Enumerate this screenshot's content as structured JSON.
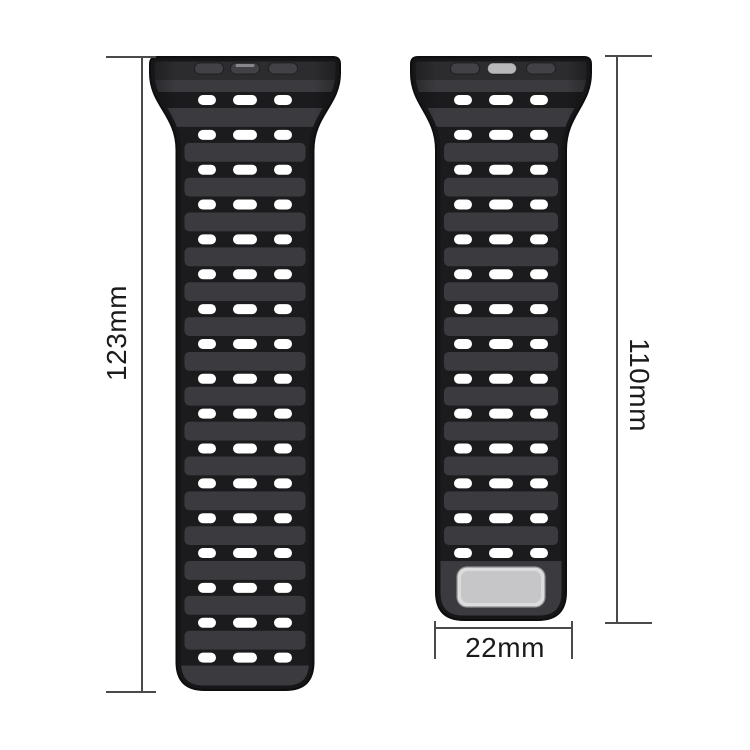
{
  "labels": {
    "left_length": "123mm",
    "right_length": "110mm",
    "width": "22mm"
  },
  "colors": {
    "background": "#ffffff",
    "strap_base": "#1b1b1d",
    "strap_plate": "#3b3b3f",
    "strap_connector": "#2c2c2f",
    "strap_edge": "#161618",
    "strap_outline": "#0e0e0f",
    "hole": "#ffffff",
    "slot_dark": "#424246",
    "slot_light": "#b8b8ba",
    "slot_highlight": "#8f8f93",
    "buckle_outer": "#dcdcdd",
    "buckle_inner": "#c6c6c8",
    "buckle_stroke": "#909094",
    "dimension_line": "#4a4a4a",
    "dimension_text": "#1b1b1b"
  },
  "straps": [
    {
      "name": "strap-long",
      "length_label": "123mm",
      "rows": 17,
      "holes_per_row": 3,
      "center_slot_light": false,
      "center_slot_highlight": true,
      "has_buckle": false,
      "geometry": {
        "cx": 245,
        "top_y": 57,
        "top_w": 190,
        "band_w": 137,
        "flare_end_y": 150,
        "bottom_y": 690,
        "row_start_y": 100,
        "row_step": 34.85,
        "hole_offsets": [
          -38,
          0,
          38
        ],
        "hole_widths": [
          18,
          24,
          18
        ],
        "hole_h": 10,
        "slot_offsets": [
          -36,
          0,
          38
        ],
        "slot_w": 29,
        "slot_h": 11
      }
    },
    {
      "name": "strap-short",
      "length_label": "110mm",
      "rows": 14,
      "holes_per_row": 3,
      "center_slot_light": true,
      "center_slot_highlight": false,
      "has_buckle": true,
      "geometry": {
        "cx": 501,
        "top_y": 57,
        "top_w": 180,
        "band_w": 130,
        "flare_end_y": 150,
        "bottom_y": 620,
        "row_start_y": 100,
        "row_step": 34.85,
        "hole_offsets": [
          -38,
          0,
          38
        ],
        "hole_widths": [
          18,
          24,
          18
        ],
        "hole_h": 10,
        "slot_offsets": [
          -36,
          1,
          40
        ],
        "slot_w": 29,
        "slot_h": 11
      },
      "buckle": {
        "w": 88,
        "h": 40,
        "cy": 587
      }
    }
  ],
  "guides": {
    "left": {
      "line_x": 141,
      "y1": 57,
      "y2": 692,
      "cap_x": 106,
      "label_cx": 117,
      "label_cy": 333
    },
    "right": {
      "line_x": 616,
      "y1": 56,
      "y2": 623,
      "cap_x": 605,
      "label_cx": 639,
      "label_cy": 385
    },
    "bottom": {
      "line_y": 627,
      "x1": 435,
      "x2": 572,
      "tick_y": 621,
      "label_cx": 505,
      "label_cy": 648
    }
  }
}
